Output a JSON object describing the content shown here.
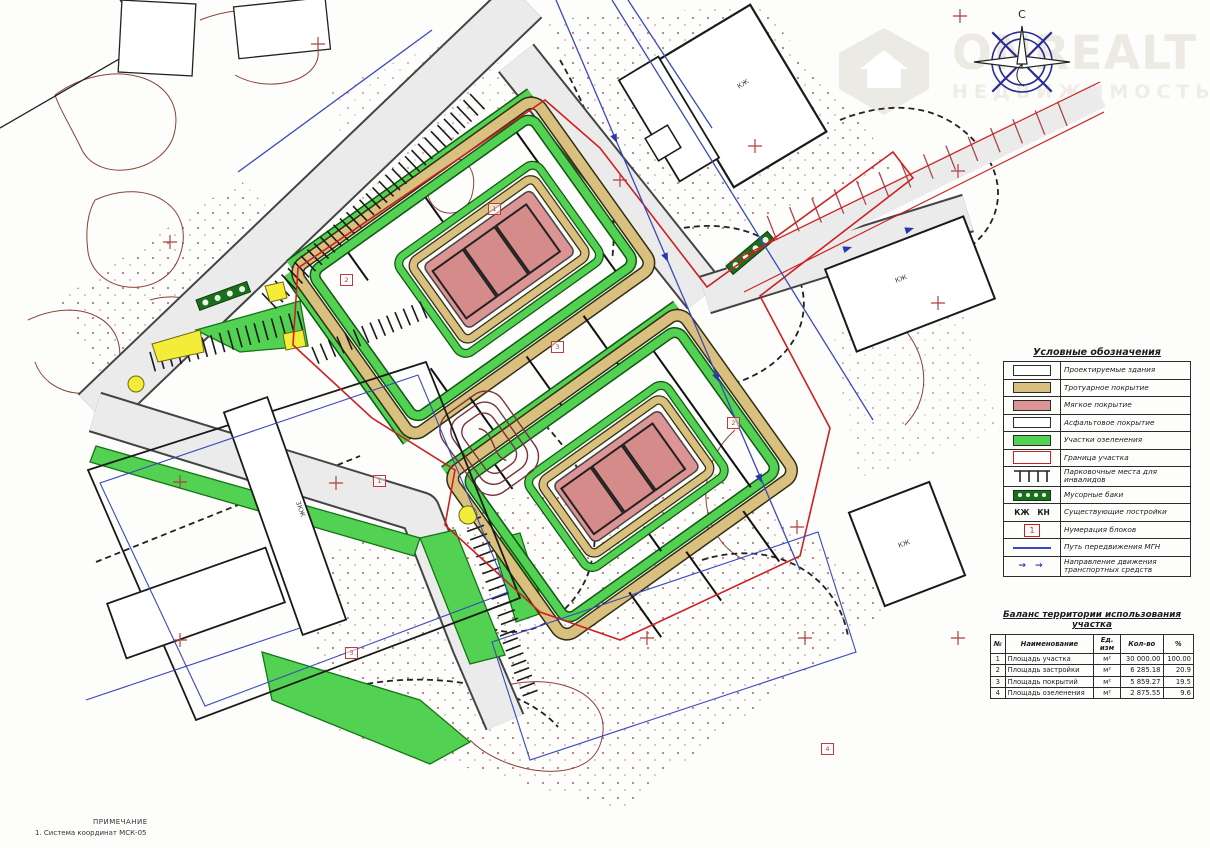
{
  "watermark": {
    "brand": "ONREALT",
    "subtitle": "НЕДВИЖИМОСТЬ"
  },
  "compass": {
    "north_label": "С"
  },
  "legend": {
    "title": "Условные обозначения",
    "items": [
      {
        "label": "Проектируемые здания"
      },
      {
        "label": "Тротуарное покрытие"
      },
      {
        "label": "Мягкое покрытие"
      },
      {
        "label": "Асфальтовое покрытие"
      },
      {
        "label": "Участки озеленения"
      },
      {
        "label": "Граница участка"
      },
      {
        "label": "Парковочные места для инвалидов"
      },
      {
        "label": "Мусорные баки"
      },
      {
        "label": "Существующие постройки",
        "symbol_text": "КЖ   КН"
      },
      {
        "label": "Нумерация блоков",
        "symbol_text": "1"
      },
      {
        "label": "Путь передвижения МГН"
      },
      {
        "label": "Направление движения транспортных средств"
      }
    ]
  },
  "balance_table": {
    "title": "Баланс территории использования участка",
    "headers": [
      "№",
      "Наименование",
      "Ед. изм",
      "Кол-во",
      "%"
    ],
    "rows": [
      [
        "1",
        "Площадь участка",
        "м²",
        "30 000.00",
        "100.00"
      ],
      [
        "2",
        "Площадь застройки",
        "м²",
        "6 285.18",
        "20.9"
      ],
      [
        "3",
        "Площадь покрытий",
        "м²",
        "5 859.27",
        "19.5"
      ],
      [
        "4",
        "Площадь озеленения",
        "м²",
        "2 875.55",
        "9.6"
      ]
    ]
  },
  "notes": {
    "heading": "ПРИМЕЧАНИЕ",
    "line1": "1. Система координат МСК-05"
  },
  "block_markers": [
    "1",
    "2",
    "3",
    "1",
    "2",
    "3",
    "4"
  ],
  "plan_labels": [
    "КЖ",
    "КЖ",
    "3КЖ",
    "КЖ"
  ],
  "colors": {
    "greenery": "#52d152",
    "sidewalk_tan": "#d9c07f",
    "soft_cover_pink": "#dc9494",
    "boundary_red": "#cc2020",
    "mgn_blue": "#3a4ab8",
    "road_gray": "#ebebeb",
    "accent_yellow": "#f3ec38"
  }
}
